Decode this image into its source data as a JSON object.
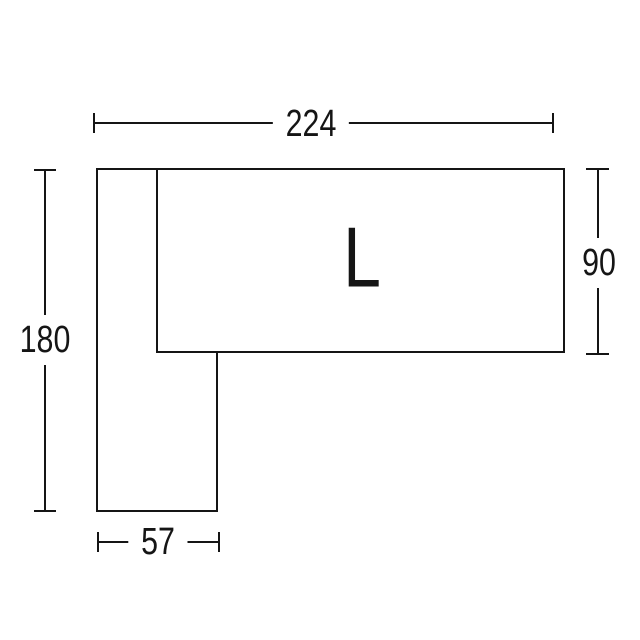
{
  "figure": {
    "label": "L",
    "background_color": "#ffffff",
    "line_color": "#151515"
  },
  "dimensions": {
    "top_width": {
      "value": "224",
      "side": "top"
    },
    "left_height": {
      "value": "180",
      "side": "left"
    },
    "right_depth": {
      "value": "90",
      "side": "right"
    },
    "bottom_leg_width": {
      "value": "57",
      "side": "bottom"
    }
  }
}
